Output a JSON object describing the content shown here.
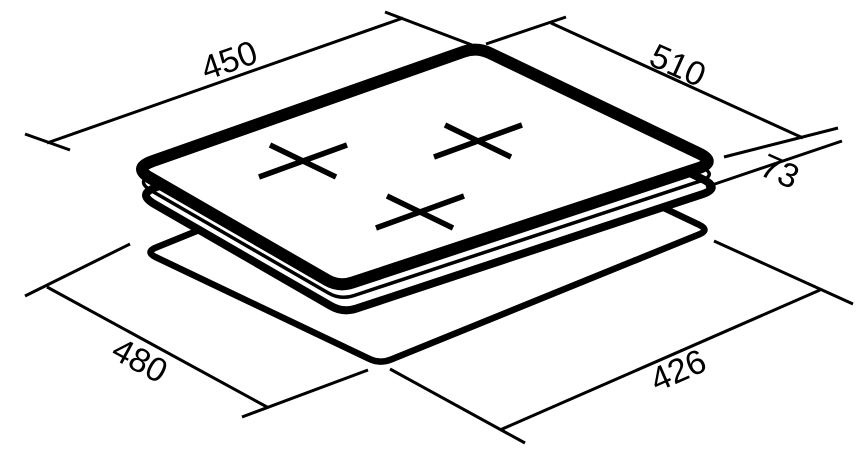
{
  "page": {
    "background": "#ffffff",
    "line_color": "#000000"
  },
  "drawing": {
    "description": "isometric dimension drawing of built-in hob with worktop cutout",
    "burner_mark_count": 3,
    "dimensions": {
      "top_left": "450",
      "top_right": "510",
      "right_height": "73",
      "bottom_left": "480",
      "bottom_right": "426"
    }
  }
}
